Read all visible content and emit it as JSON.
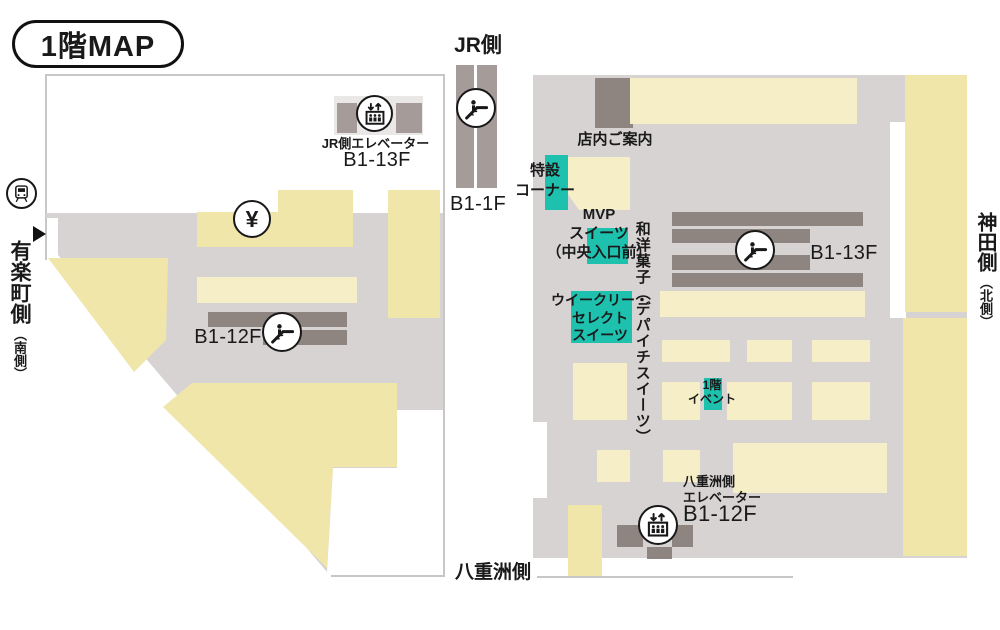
{
  "title": "1階MAP",
  "compass": {
    "jr_side": "JR側",
    "yurakucho_side": "有楽町側",
    "yurakucho_sub": "（南側）",
    "kanda_side": "神田側",
    "kanda_sub": "（北側）",
    "yaesu_side": "八重洲側"
  },
  "left_building": {
    "jr_elevator_label": "JR側エレベーター",
    "jr_elevator_floors": "B1-13F",
    "escalator_floors": "B1-12F",
    "atm_symbol": "¥"
  },
  "jr_track": {
    "escalator_floors": "B1-1F"
  },
  "right_building": {
    "store_guide": "店内ご案内",
    "special_corner": "特設\nコーナー",
    "mvp_sweets": "MVP\nスイーツ\n（中央入口前）",
    "weekly_select": "ウイークリー・\nセレクト\nスイーツ",
    "confectionery_vertical": "和洋菓子（デパイチスイーツ）",
    "escalator_floors": "B1-13F",
    "event_space": "1階\nイベント",
    "yaesu_elevator_label": "八重洲側\nエレベーター",
    "yaesu_elevator_floors": "B1-12F"
  },
  "colors": {
    "floor": "#d8d3d3",
    "sales_area": "#f0e6aa",
    "sales_area_light": "#f5eec6",
    "fixture_dark": "#8e8480",
    "fixture_mid": "#a59c9a",
    "highlight_teal": "#1ec0ae",
    "outline": "#c9c6c6",
    "text": "#1a1a1a"
  }
}
